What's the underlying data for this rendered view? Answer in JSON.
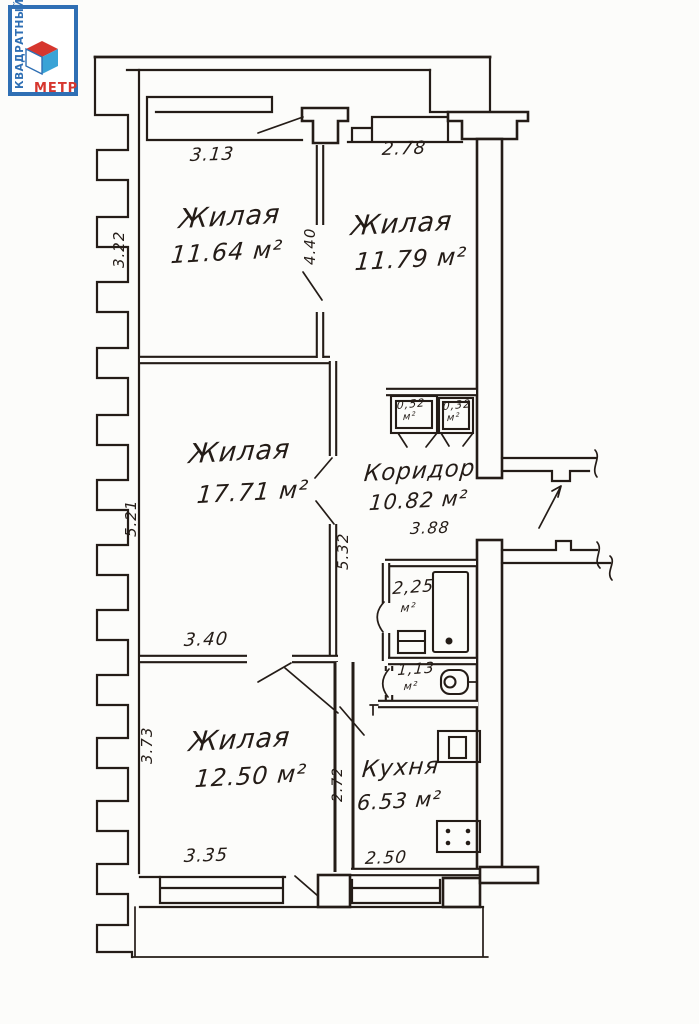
{
  "logo": {
    "vertical_text": "КВАДРАТНЫЙ",
    "bottom_text": "МЕТР",
    "border_color": "#2f6fb4",
    "accent_red": "#d6362e",
    "cube_blue": "#3aa3d6"
  },
  "rooms": {
    "living1": {
      "label": "Жилая",
      "area": "11.64 м²"
    },
    "living2": {
      "label": "Жилая",
      "area": "11.79 м²"
    },
    "living3": {
      "label": "Жилая",
      "area": "17.71 м²"
    },
    "living4": {
      "label": "Жилая",
      "area": "12.50 м²"
    },
    "corridor": {
      "label": "Коридор",
      "area": "10.82 м²"
    },
    "kitchen": {
      "label": "Кухня",
      "area": "6.53 м²"
    },
    "bathroom": {
      "area": "2,25",
      "unit": "м²"
    },
    "wc": {
      "area": "1,13",
      "unit": "м²"
    },
    "closet1": {
      "area": "0,52",
      "unit": "м²"
    },
    "closet2": {
      "area": "0,32",
      "unit": "м²"
    }
  },
  "dimensions": {
    "living1_width": "3.13",
    "living1_depth": "3.22",
    "living2_width": "2.78",
    "living2_depth": "4.40",
    "living3_depth": "5.21",
    "corridor_depth": "5.32",
    "corridor_length": "3.88",
    "living4_top_width": "3.40",
    "living4_depth": "3.73",
    "living4_width": "3.35",
    "kitchen_width": "2.50",
    "kitchen_depth": "2.72"
  }
}
